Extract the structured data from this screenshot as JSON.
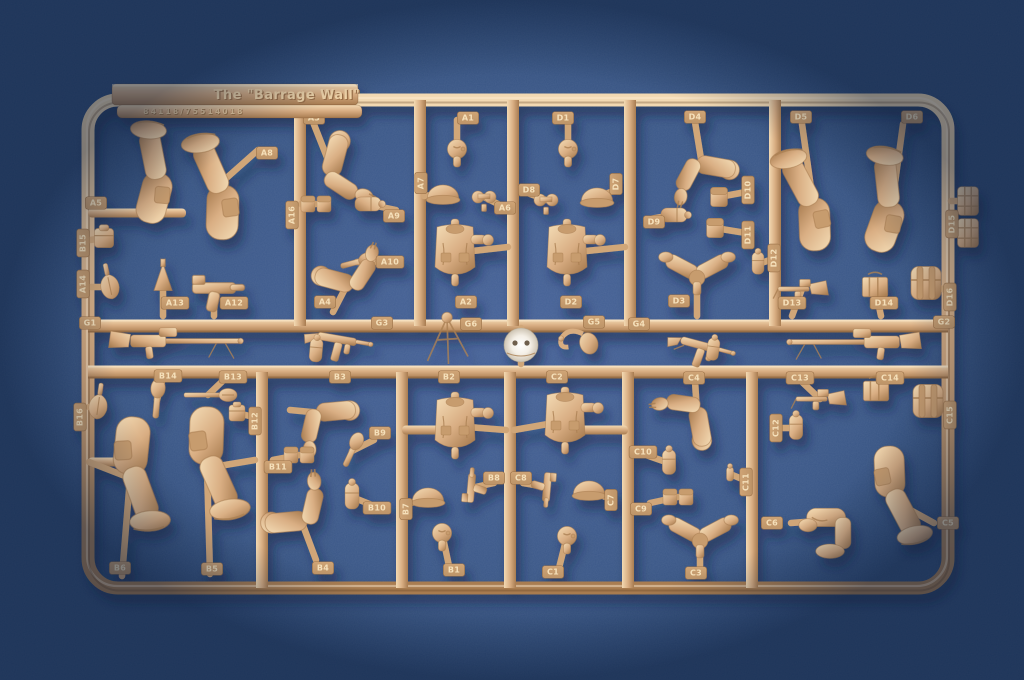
{
  "sprue": {
    "title": "The \"Barrage Wall\"",
    "part_number": "84118/75514018",
    "frame": {
      "outer": {
        "x": 88,
        "y": 100,
        "w": 860,
        "h": 488,
        "r": 30,
        "t": 13
      },
      "mid_rails_y": [
        326,
        372
      ],
      "verticals_top": [
        300,
        420,
        513,
        630,
        775
      ],
      "verticals_bottom": [
        262,
        402,
        510,
        628,
        752
      ],
      "tab": {
        "x": 112,
        "y": 84,
        "w": 246,
        "h": 21,
        "title_x": 287,
        "title_y": 99
      },
      "numbar": {
        "x": 117,
        "y": 105,
        "w": 245,
        "h": 13,
        "num_x": 194,
        "num_y": 114
      },
      "bars": [
        {
          "x1": 88,
          "y": 213,
          "x2": 186
        },
        {
          "x1": 402,
          "y": 430,
          "x2": 455
        },
        {
          "x1": 565,
          "y": 430,
          "x2": 628
        },
        {
          "x1": 88,
          "y": 462,
          "x2": 118
        }
      ]
    },
    "parts": [
      {
        "id": "A5",
        "type": "leg",
        "x": 160,
        "y": 170,
        "rot": 185,
        "sc": 1.5,
        "ax": 150,
        "ay": 213,
        "lx": 96,
        "ly": 203
      },
      {
        "id": "A8",
        "type": "leg",
        "x": 222,
        "y": 182,
        "rot": 172,
        "sc": 1.6,
        "ax": 258,
        "ay": 150,
        "lx": 267,
        "ly": 153
      },
      {
        "id": "B15",
        "type": "cube",
        "x": 104,
        "y": 238,
        "sc": 1.2,
        "ax": 90,
        "ay": 240,
        "lx": 83,
        "ly": 243,
        "lv": true
      },
      {
        "id": "A14",
        "type": "spade",
        "x": 110,
        "y": 287,
        "rot": -12,
        "ax": 91,
        "ay": 287,
        "lx": 83,
        "ly": 284,
        "lv": true
      },
      {
        "id": "A13",
        "type": "stake",
        "x": 163,
        "y": 280,
        "sc": 1.5,
        "ax": 163,
        "ay": 316,
        "lx": 175,
        "ly": 303
      },
      {
        "id": "A12",
        "type": "pistol",
        "x": 214,
        "y": 288,
        "sc": 1.8,
        "ax": 214,
        "ay": 316,
        "lx": 234,
        "ly": 303
      },
      {
        "id": "G1",
        "type": "mg",
        "x": 168,
        "y": 341,
        "sc": 1.1,
        "flip": true,
        "lx": 90,
        "ly": 323
      },
      {
        "id": "A3",
        "type": "arm",
        "x": 332,
        "y": 170,
        "rot": 15,
        "sc": 1.5,
        "ax": 313,
        "ay": 122,
        "lx": 314,
        "ly": 118
      },
      {
        "id": "A16",
        "type": "pouch_pair",
        "x": 316,
        "y": 204,
        "ax": 301,
        "ay": 204,
        "lx": 292,
        "ly": 215,
        "lv": true
      },
      {
        "id": "A9",
        "type": "canteen",
        "x": 367,
        "y": 204,
        "rot": 90,
        "ax": 396,
        "ay": 210,
        "lx": 394,
        "ly": 216
      },
      {
        "id": "A10",
        "type": "grenade",
        "x": 357,
        "y": 262,
        "rot": 75,
        "sc": 1.2,
        "ax": 390,
        "ay": 262,
        "lx": 390,
        "ly": 262
      },
      {
        "id": "A4",
        "type": "arm",
        "x": 348,
        "y": 283,
        "rot": -75,
        "sc": 1.4,
        "ax": 333,
        "ay": 312,
        "lx": 325,
        "ly": 302
      },
      {
        "id": "G3",
        "type": "smg",
        "x": 337,
        "y": 339,
        "rot": 10,
        "sc": 1.1,
        "lx": 382,
        "ly": 323
      },
      {
        "type": "canteen",
        "x": 316,
        "y": 351,
        "rot": 5,
        "sc": 0.9
      },
      {
        "id": "A1",
        "type": "head",
        "x": 457,
        "y": 149,
        "sc": 1.2,
        "ax": 457,
        "ay": 120,
        "lx": 468,
        "ly": 118
      },
      {
        "id": "A7",
        "type": "helmet",
        "x": 443,
        "y": 194,
        "sc": 1.3,
        "ax": 424,
        "ay": 196,
        "lx": 421,
        "ly": 183,
        "lv": true
      },
      {
        "id": "A6",
        "type": "binoculars",
        "x": 484,
        "y": 197,
        "sc": 1.2,
        "ax": 506,
        "ay": 208,
        "lx": 505,
        "ly": 208
      },
      {
        "id": "A2",
        "type": "torso",
        "x": 455,
        "y": 253,
        "ax": 508,
        "ay": 247,
        "lx": 466,
        "ly": 302
      },
      {
        "id": "G6",
        "type": "tripod",
        "x": 447,
        "y": 340,
        "sc": 1.5,
        "lx": 471,
        "ly": 324
      },
      {
        "type": "white_helmet",
        "x": 521,
        "y": 345,
        "ax": 521,
        "ay": 328,
        "ax2": 521,
        "ay2": 364
      },
      {
        "id": "D1",
        "type": "head",
        "x": 568,
        "y": 149,
        "sc": 1.2,
        "ax": 568,
        "ay": 120,
        "lx": 563,
        "ly": 118
      },
      {
        "id": "D8",
        "type": "binoculars",
        "x": 546,
        "y": 200,
        "sc": 1.2,
        "ax": 525,
        "ay": 192,
        "lx": 529,
        "ly": 190
      },
      {
        "id": "D7",
        "type": "helmet",
        "x": 597,
        "y": 197,
        "sc": 1.3,
        "ax": 616,
        "ay": 190,
        "lx": 616,
        "ly": 184,
        "lv": true
      },
      {
        "id": "D2",
        "type": "torso",
        "x": 567,
        "y": 253,
        "ax": 625,
        "ay": 247,
        "lx": 571,
        "ly": 302
      },
      {
        "id": "G5",
        "type": "bugle",
        "x": 578,
        "y": 341,
        "sc": 1.2,
        "lx": 594,
        "ly": 322
      },
      {
        "id": "D4",
        "type": "arm",
        "x": 702,
        "y": 165,
        "rot": 100,
        "sc": 1.4,
        "ax": 695,
        "ay": 122,
        "lx": 695,
        "ly": 117
      },
      {
        "id": "D9",
        "type": "canteen",
        "x": 673,
        "y": 215,
        "rot": 90,
        "ax": 650,
        "ay": 219,
        "lx": 654,
        "ly": 222
      },
      {
        "id": "D10",
        "type": "pouch",
        "x": 719,
        "y": 197,
        "sc": 1.2,
        "ax": 746,
        "ay": 192,
        "lx": 748,
        "ly": 190,
        "lv": true
      },
      {
        "id": "D11",
        "type": "pouch",
        "x": 715,
        "y": 228,
        "sc": 1.2,
        "ax": 746,
        "ay": 233,
        "lx": 748,
        "ly": 235,
        "lv": true
      },
      {
        "id": "D12",
        "type": "canteen",
        "x": 758,
        "y": 264,
        "sc": 0.85,
        "ax": 773,
        "ay": 259,
        "lx": 774,
        "ly": 258,
        "lv": true
      },
      {
        "id": "D3",
        "type": "arms_v",
        "x": 697,
        "y": 274,
        "sc": 1.3,
        "ax": 697,
        "ay": 316,
        "lx": 679,
        "ly": 301
      },
      {
        "id": "G4",
        "type": "smg",
        "x": 700,
        "y": 345,
        "rot": 15,
        "sc": 1.1,
        "lx": 639,
        "ly": 324
      },
      {
        "type": "canteen",
        "x": 713,
        "y": 350,
        "rot": 8,
        "sc": 0.85
      },
      {
        "id": "D5",
        "type": "leg",
        "x": 812,
        "y": 195,
        "rot": 168,
        "sc": 1.55,
        "ax": 802,
        "ay": 124,
        "lx": 801,
        "ly": 117
      },
      {
        "id": "D6",
        "type": "leg",
        "x": 893,
        "y": 198,
        "rot": 190,
        "sc": 1.55,
        "ax": 903,
        "ay": 124,
        "lx": 912,
        "ly": 117
      },
      {
        "id": "D13",
        "type": "minigun",
        "x": 802,
        "y": 289,
        "sc": 1.2,
        "ax": 792,
        "ay": 316,
        "lx": 792,
        "ly": 303
      },
      {
        "id": "D14",
        "type": "box",
        "x": 875,
        "y": 287,
        "sc": 1.4,
        "ax": 881,
        "ay": 316,
        "lx": 884,
        "ly": 303
      },
      {
        "id": "D16",
        "type": "backpack",
        "x": 926,
        "y": 283,
        "sc": 1.5,
        "ax": 945,
        "ay": 290,
        "lx": 950,
        "ly": 297,
        "lv": true
      },
      {
        "id": "D15",
        "type": "flatpouch",
        "x": 968,
        "y": 201,
        "sc": 1.3,
        "ax": 951,
        "ay": 201,
        "lx": 952,
        "ly": 224,
        "lv": true
      },
      {
        "type": "flatpouch",
        "x": 968,
        "y": 233,
        "sc": 1.3,
        "ax": 951,
        "ay": 233
      },
      {
        "id": "G2",
        "type": "mg",
        "x": 862,
        "y": 342,
        "sc": 1.1,
        "lx": 944,
        "ly": 322
      },
      {
        "id": "B16",
        "type": "spade",
        "x": 98,
        "y": 407,
        "rot": 8,
        "ax": 89,
        "ay": 407,
        "lx": 80,
        "ly": 417,
        "lv": true
      },
      {
        "id": "B14",
        "type": "grenade",
        "x": 157,
        "y": 400,
        "rot": 5,
        "sc": 1.3,
        "ax": 164,
        "ay": 374,
        "lx": 168,
        "ly": 376
      },
      {
        "id": "B13",
        "type": "etool",
        "x": 208,
        "y": 395,
        "ax": 230,
        "ay": 374,
        "lx": 233,
        "ly": 377
      },
      {
        "id": "B6",
        "type": "leg",
        "x": 130,
        "y": 478,
        "rot": -4,
        "sc": 1.7,
        "ax": 89,
        "ay": 462,
        "ax2": 122,
        "ay2": 576,
        "lx": 120,
        "ly": 568
      },
      {
        "id": "B5",
        "type": "leg",
        "x": 207,
        "y": 468,
        "rot": -8,
        "sc": 1.7,
        "ax": 255,
        "ay": 460,
        "ax2": 210,
        "ay2": 574,
        "lx": 212,
        "ly": 569
      },
      {
        "id": "B12",
        "type": "cube",
        "x": 237,
        "y": 413,
        "ax": 258,
        "ay": 418,
        "lx": 255,
        "ly": 421,
        "lv": true
      },
      {
        "id": "B3",
        "type": "arm",
        "x": 322,
        "y": 413,
        "rot": 85,
        "sc": 1.4,
        "ax": 290,
        "ay": 410,
        "lx": 340,
        "ly": 377
      },
      {
        "id": "B11",
        "type": "pouch_pair",
        "x": 299,
        "y": 455,
        "ax": 273,
        "ay": 460,
        "lx": 278,
        "ly": 467
      },
      {
        "id": "B9",
        "type": "grenade",
        "x": 352,
        "y": 451,
        "rot": 25,
        "sc": 1.2,
        "ax": 374,
        "ay": 440,
        "lx": 380,
        "ly": 433
      },
      {
        "id": "B10",
        "type": "canteen",
        "x": 352,
        "y": 497,
        "ax": 372,
        "ay": 505,
        "lx": 377,
        "ly": 508
      },
      {
        "id": "B4",
        "type": "arm",
        "x": 301,
        "y": 520,
        "rot": -95,
        "sc": 1.5,
        "ax": 316,
        "ay": 560,
        "lx": 323,
        "ly": 568
      },
      {
        "id": "B2",
        "type": "torso",
        "x": 455,
        "y": 426,
        "ax": 506,
        "ay": 430,
        "lx": 449,
        "ly": 377
      },
      {
        "id": "B8",
        "type": "pistol",
        "x": 471,
        "y": 488,
        "rot": -85,
        "sc": 1.2,
        "ax": 494,
        "ay": 483,
        "lx": 494,
        "ly": 478
      },
      {
        "id": "B7",
        "type": "helmet",
        "x": 428,
        "y": 497,
        "sc": 1.3,
        "ax": 408,
        "ay": 504,
        "lx": 406,
        "ly": 509,
        "lv": true
      },
      {
        "id": "B1",
        "type": "head",
        "x": 442,
        "y": 533,
        "sc": 1.2,
        "ax": 449,
        "ay": 566,
        "lx": 454,
        "ly": 570
      },
      {
        "id": "C2",
        "type": "torso",
        "x": 565,
        "y": 421,
        "ax": 514,
        "ay": 430,
        "lx": 557,
        "ly": 377
      },
      {
        "id": "C8",
        "type": "pistol",
        "x": 547,
        "y": 487,
        "rot": 95,
        "sc": 1.2,
        "ax": 523,
        "ay": 483,
        "lx": 521,
        "ly": 478
      },
      {
        "id": "C7",
        "type": "helmet",
        "x": 589,
        "y": 490,
        "sc": 1.3,
        "ax": 608,
        "ay": 498,
        "lx": 611,
        "ly": 500,
        "lv": true
      },
      {
        "id": "C1",
        "type": "head",
        "x": 567,
        "y": 536,
        "sc": 1.2,
        "ax": 559,
        "ay": 568,
        "lx": 553,
        "ly": 572
      },
      {
        "id": "C4",
        "type": "arm",
        "x": 697,
        "y": 413,
        "rot": 170,
        "sc": 1.4,
        "ax": 695,
        "ay": 381,
        "lx": 694,
        "ly": 378
      },
      {
        "id": "C10",
        "type": "canteen",
        "x": 669,
        "y": 463,
        "sc": 0.95,
        "ax": 646,
        "ay": 455,
        "lx": 643,
        "ly": 452
      },
      {
        "id": "C9",
        "type": "pouch_pair",
        "x": 678,
        "y": 497,
        "ax": 650,
        "ay": 503,
        "lx": 641,
        "ly": 509
      },
      {
        "id": "C11",
        "type": "smallbit",
        "x": 730,
        "y": 474,
        "ax": 747,
        "ay": 481,
        "lx": 746,
        "ly": 482,
        "lv": true
      },
      {
        "id": "C3",
        "type": "arms_v",
        "x": 700,
        "y": 537,
        "sc": 1.3,
        "ax": 700,
        "ay": 572,
        "lx": 696,
        "ly": 573
      },
      {
        "id": "C13",
        "type": "minigun",
        "x": 820,
        "y": 399,
        "sc": 1.2,
        "ax": 801,
        "ay": 381,
        "lx": 800,
        "ly": 378
      },
      {
        "id": "C14",
        "type": "box",
        "x": 876,
        "y": 391,
        "sc": 1.4,
        "ax": 886,
        "ay": 379,
        "lx": 890,
        "ly": 378
      },
      {
        "id": "C15",
        "type": "backpack",
        "x": 928,
        "y": 401,
        "sc": 1.5,
        "ax": 946,
        "ay": 408,
        "lx": 950,
        "ly": 415,
        "lv": true
      },
      {
        "id": "C12",
        "type": "canteen",
        "x": 796,
        "y": 428,
        "sc": 0.95,
        "ax": 777,
        "ay": 428,
        "lx": 776,
        "ly": 428,
        "lv": true
      },
      {
        "id": "C6",
        "type": "kneel",
        "x": 830,
        "y": 520,
        "sc": 1.3,
        "ax": 791,
        "ay": 523,
        "lx": 772,
        "ly": 523
      },
      {
        "id": "C5",
        "type": "leg",
        "x": 892,
        "y": 500,
        "rot": -12,
        "sc": 1.5,
        "ax": 934,
        "ay": 523,
        "lx": 948,
        "ly": 523
      }
    ]
  },
  "colors": {
    "bg_center": "#47639a",
    "bg_edge": "#2a4673",
    "plastic_light": "#f2d9b2",
    "plastic_mid": "#d9ae83",
    "plastic_dark": "#a87c50",
    "plate_top": "#cfa475",
    "plate_bottom": "#bd9468",
    "label_text": "#f5e0ba",
    "title_light": "#f0d4a8",
    "title_dark": "#9a7049",
    "num_light": "#e8c89c",
    "num_dark": "#9d7449",
    "white_part": "#f4efe6",
    "white_part_shade": "#cdc3b2",
    "cast_shadow": "#10223f"
  }
}
